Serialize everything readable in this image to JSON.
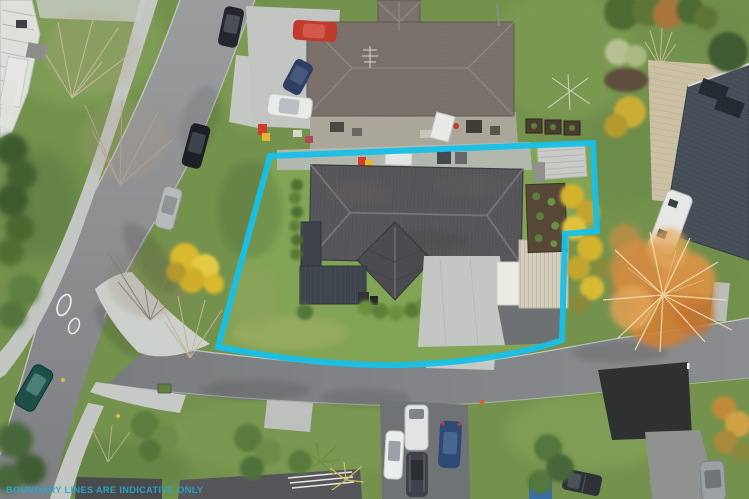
{
  "overlay": {
    "watermark_text": "BOUNDARY LINES ARE INDICATIVE ONLY",
    "boundary_vertices_px": [
      [
        270,
        156
      ],
      [
        593,
        143
      ],
      [
        597,
        231
      ],
      [
        565,
        234
      ],
      [
        562,
        340
      ],
      [
        400,
        365
      ],
      [
        218,
        347
      ]
    ],
    "boundary_stroke_px": 6
  },
  "colors": {
    "boundary_color": "#16c1e9",
    "watermark_color": "#25a9cf",
    "lawn_color": "#82a455",
    "grass_color": "#74924d",
    "roof_main_color": "#58585c",
    "roof_north_color": "#7b716b",
    "roof_east_color": "#454d57",
    "carport_color": "#d5cebc",
    "concrete_color": "#c3c6c3"
  },
  "scene": {
    "type": "aerial drone photograph, real-estate listing",
    "season": "winter (bare trees, autumn-coloured foliage)",
    "subject_property": {
      "features": [
        "dark grey hipped tile roof",
        "front gable wing",
        "dark flat-roof garage wing",
        "concrete driveway",
        "ribbed cream carport",
        "white garage panel",
        "vegetable garden beds",
        "small shed",
        "lawn",
        "hedges"
      ]
    },
    "neighbors": [
      "north house with taupe hip roof and deck",
      "east house with slate roof, timber deck and white caravan",
      "south houses partially visible at bottom edge"
    ],
    "streets": [
      "curving street on the left with footpath and traffic islands",
      "side street across the bottom of the lot"
    ],
    "vehicles": [
      {
        "name": "teal-car-on-road",
        "color": "dark teal"
      },
      {
        "name": "black-car-kerb",
        "color": "black"
      },
      {
        "name": "silver-car-kerb",
        "color": "silver"
      },
      {
        "name": "dark-car-top",
        "color": "dark grey"
      },
      {
        "name": "red-car-north-drive",
        "color": "red"
      },
      {
        "name": "navy-car-north-drive",
        "color": "navy"
      },
      {
        "name": "white-car-north-drive",
        "color": "white"
      },
      {
        "name": "white-van-south",
        "color": "white"
      },
      {
        "name": "white-sedan-south",
        "color": "white"
      },
      {
        "name": "dark-car-south",
        "color": "dark grey"
      },
      {
        "name": "navy-car-south",
        "color": "navy blue"
      },
      {
        "name": "grey-suv-south",
        "color": "grey"
      },
      {
        "name": "dark-ute-south",
        "color": "dark grey"
      },
      {
        "name": "white-caravan-east",
        "color": "white"
      }
    ],
    "vegetation": [
      "large salmon-orange autumn tree right of lot",
      "yellow autumn shrubs along right boundary and left of lot",
      "bare winter trees along left street",
      "dark green hedges far left",
      "palms and shrubs along bottom"
    ]
  }
}
